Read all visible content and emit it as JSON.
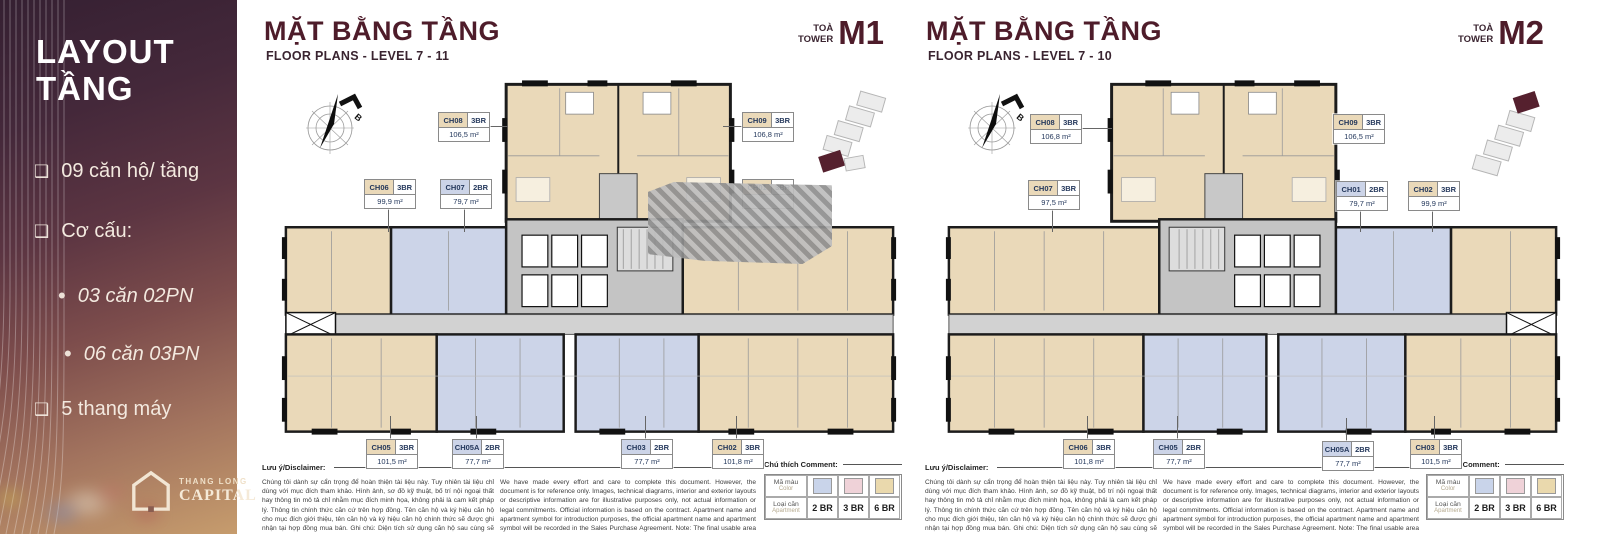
{
  "sidebar": {
    "title_line1": "LAYOUT",
    "title_line2": "TẦNG",
    "items": [
      {
        "marker": "❑",
        "text": "09 căn hộ/ tầng"
      },
      {
        "marker": "❑",
        "text": "Cơ cấu:"
      },
      {
        "marker": "•",
        "text": "03 căn 02PN"
      },
      {
        "marker": "•",
        "text": "06 căn 03PN"
      },
      {
        "marker": "❑",
        "text": "5 thang máy"
      }
    ],
    "logo_line1": "THANG LONG",
    "logo_line2": "CAPITAL"
  },
  "panels": [
    {
      "title": "MẶT BẰNG TẦNG",
      "subtitle": "FLOOR PLANS - LEVEL 7 - 11",
      "tower_prefix_1": "TOÀ",
      "tower_prefix_2": "TOWER",
      "tower_code": "M1",
      "compass_label": "B",
      "units": [
        {
          "code": "CH08",
          "type": "3BR",
          "area": "106,5 m²"
        },
        {
          "code": "CH09",
          "type": "3BR",
          "area": "106,8 m²"
        },
        {
          "code": "CH06",
          "type": "3BR",
          "area": "99,9 m²"
        },
        {
          "code": "CH07",
          "type": "2BR",
          "area": "79,7 m²"
        },
        {
          "code": "CH01",
          "type": "3BR",
          "area": ""
        },
        {
          "code": "CH05",
          "type": "3BR",
          "area": "101,5 m²"
        },
        {
          "code": "CH05A",
          "type": "2BR",
          "area": "77,7 m²"
        },
        {
          "code": "CH03",
          "type": "2BR",
          "area": "77,7 m²"
        },
        {
          "code": "CH02",
          "type": "3BR",
          "area": "101,8 m²"
        }
      ]
    },
    {
      "title": "MẶT BẰNG TẦNG",
      "subtitle": "FLOOR PLANS - LEVEL 7 - 10",
      "tower_prefix_1": "TOÀ",
      "tower_prefix_2": "TOWER",
      "tower_code": "M2",
      "compass_label": "B",
      "units": [
        {
          "code": "CH08",
          "type": "3BR",
          "area": "106,8 m²"
        },
        {
          "code": "CH09",
          "type": "3BR",
          "area": "106,5 m²"
        },
        {
          "code": "CH07",
          "type": "3BR",
          "area": "97,5 m²"
        },
        {
          "code": "CH01",
          "type": "2BR",
          "area": "79,7 m²"
        },
        {
          "code": "CH02",
          "type": "3BR",
          "area": "99,9 m²"
        },
        {
          "code": "CH06",
          "type": "3BR",
          "area": "101,8 m²"
        },
        {
          "code": "CH05",
          "type": "2BR",
          "area": "77,7 m²"
        },
        {
          "code": "CH05A",
          "type": "2BR",
          "area": "77,7 m²"
        },
        {
          "code": "CH03",
          "type": "3BR",
          "area": "101,5 m²"
        }
      ]
    }
  ],
  "disclaimer": {
    "label": "Lưu ý/Disclaimer:",
    "vi": "Chúng tôi dành sự cẩn trọng để hoàn thiện tài liệu này. Tuy nhiên tài liệu chỉ dùng với mục đích tham khảo. Hình ảnh, sơ đồ kỹ thuật, bố trí nội ngoại thất hay thông tin mô tả chỉ nhằm mục đích minh họa, không phải là cam kết pháp lý. Thông tin chính thức căn cứ trên hợp đồng. Tên căn hộ và ký hiệu căn hộ cho mục đích giới thiệu, tên căn hộ và ký hiệu căn hộ chính thức sẽ được ghi nhận tại hợp đồng mua bán. Ghi chú: Diện tích sử dụng căn hộ sau cùng sẽ được xác minh bởi đơn vị đo đạc.",
    "en": "We have made every effort and care to complete this document. However, the document is for reference only. Images, technical diagrams, interior and exterior layouts or descriptive information are for illustrative purposes only, not actual information or legal commitments. Official information is based on the contract. Apartment name and apartment symbol for introduction purposes, the official apartment name and apartment symbol will be recorded in the Sales Purchase Agreement. Note: The final usable area of the apartment will be verified by the measuring unit."
  },
  "legend": {
    "title": "Chú thích Comment:",
    "row1_vi": "Mã màu",
    "row1_en": "Color",
    "row2_vi": "Loại căn",
    "row2_en": "Apartment",
    "entries": [
      {
        "label": "2 BR",
        "color": "#c9d4ea"
      },
      {
        "label": "3 BR",
        "color": "#efd2d8"
      },
      {
        "label": "6 BR",
        "color": "#ead9ad"
      }
    ]
  },
  "colors": {
    "maroon": "#4e1c2a",
    "beige_3br": "#ead9b9",
    "blue_2br": "#ccd4e8",
    "sidebar_top": "#352032",
    "sidebar_bottom": "#c69c6d"
  }
}
